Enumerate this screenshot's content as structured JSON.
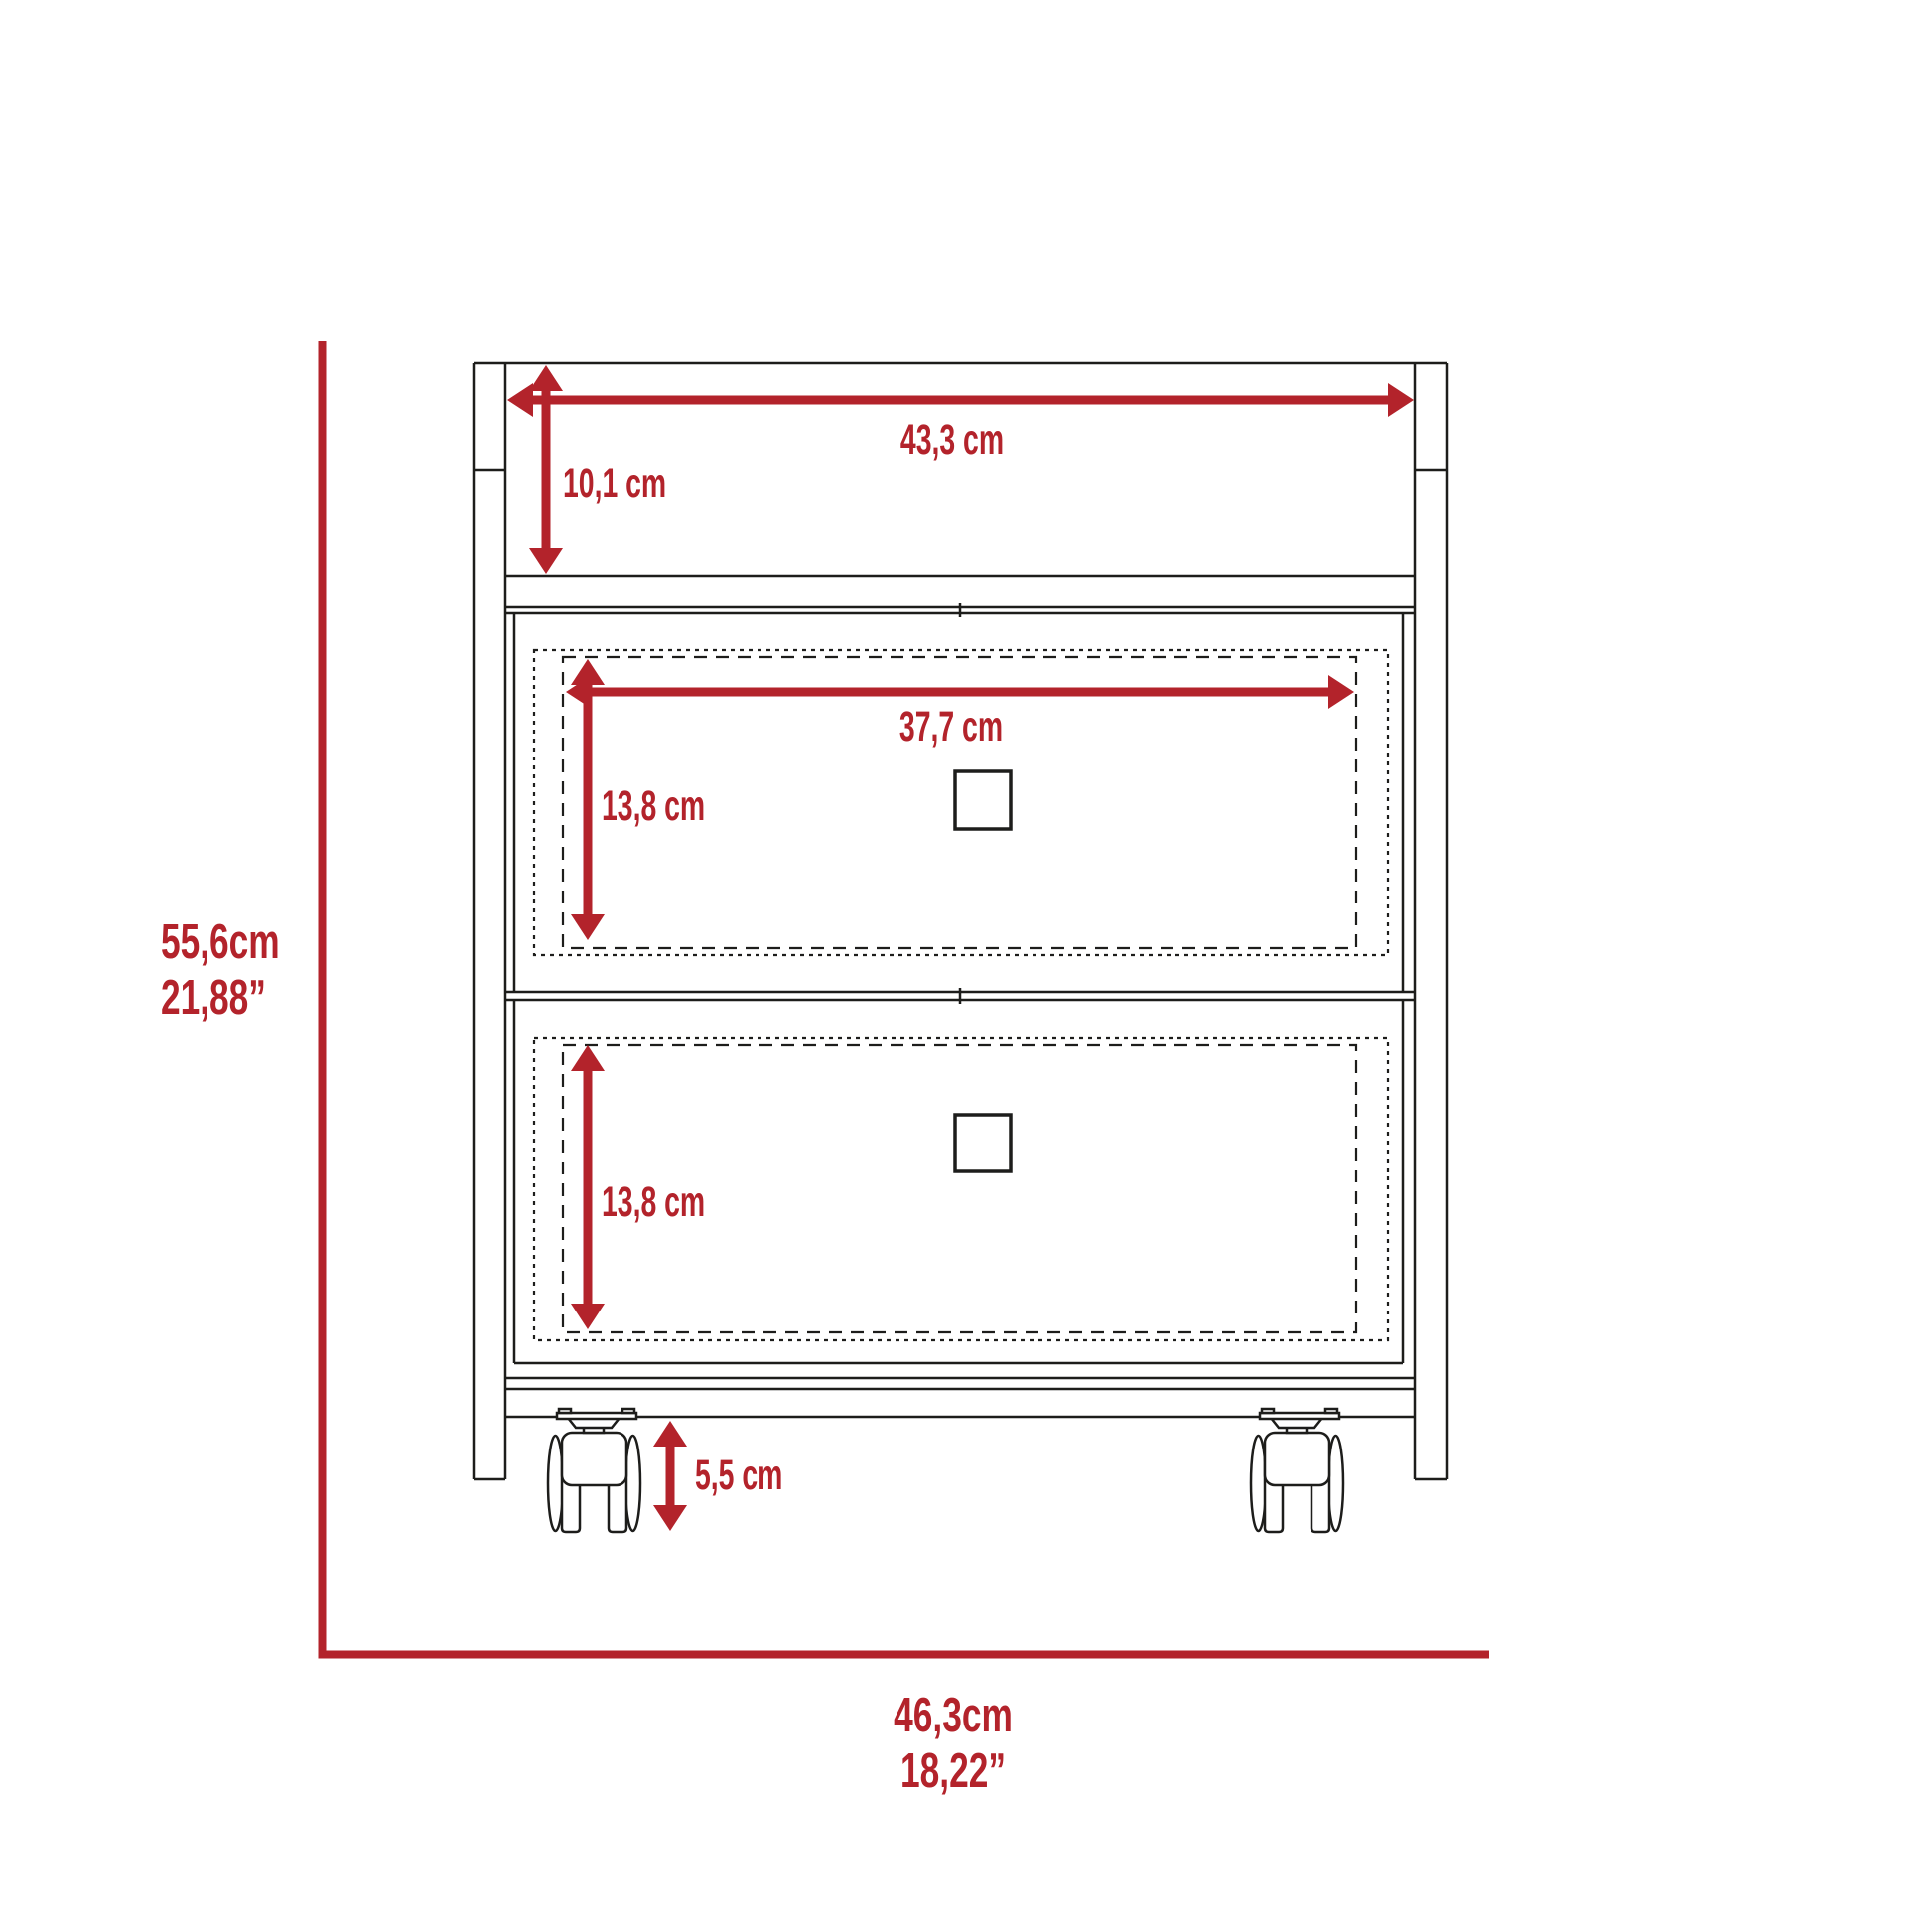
{
  "diagram": {
    "type": "furniture-dimension-diagram",
    "subject": "two-drawer mobile cabinet with casters, front elevation",
    "background_color": "#ffffff",
    "accent_color": "#b3232b",
    "line_color": "#1d1d1b",
    "labels": {
      "top_width": "43,3 cm",
      "top_compartment_height": "10,1 cm",
      "drawer_inner_width": "37,7 cm",
      "upper_drawer_height": "13,8 cm",
      "lower_drawer_height": "13,8 cm",
      "caster_height": "5,5 cm",
      "overall_height_cm": "55,6cm",
      "overall_height_in": "21,88”",
      "overall_width_cm": "46,3cm",
      "overall_width_in": "18,22”"
    },
    "measurements": [
      {
        "name": "top width",
        "value": "43,3",
        "unit": "cm"
      },
      {
        "name": "top compartment height",
        "value": "10,1",
        "unit": "cm"
      },
      {
        "name": "drawer inner width",
        "value": "37,7",
        "unit": "cm"
      },
      {
        "name": "upper drawer inner height",
        "value": "13,8",
        "unit": "cm"
      },
      {
        "name": "lower drawer inner height",
        "value": "13,8",
        "unit": "cm"
      },
      {
        "name": "caster height",
        "value": "5,5",
        "unit": "cm"
      },
      {
        "name": "overall height",
        "value": "55,6",
        "unit": "cm",
        "alt_value": "21,88",
        "alt_unit": "in"
      },
      {
        "name": "overall width",
        "value": "46,3",
        "unit": "cm",
        "alt_value": "18,22",
        "alt_unit": "in"
      }
    ]
  }
}
